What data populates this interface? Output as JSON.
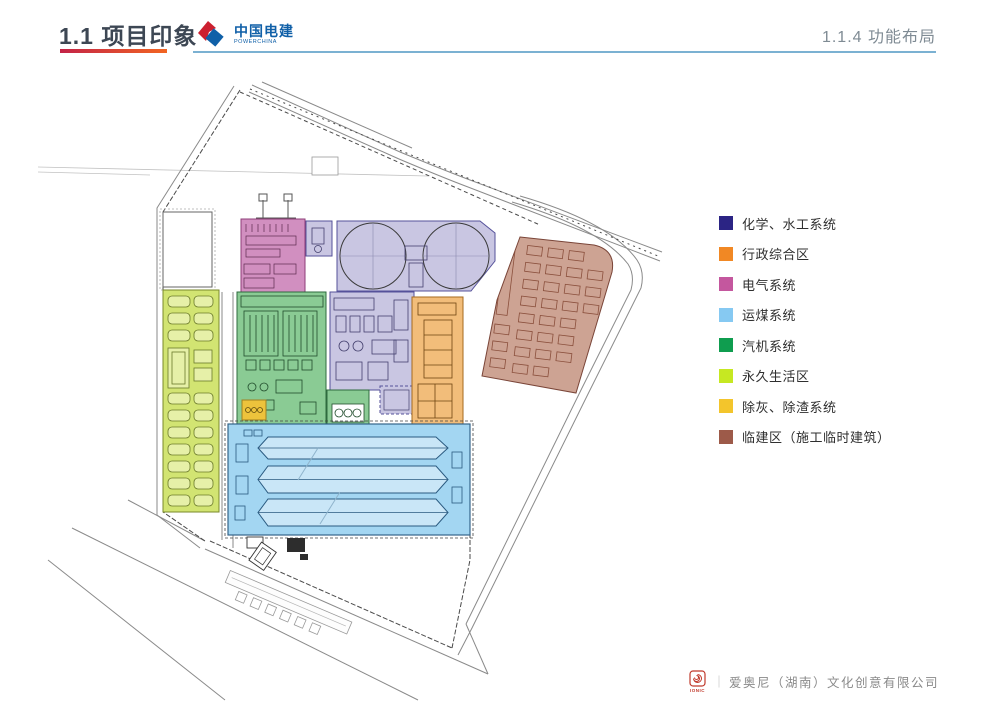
{
  "header": {
    "section_title": "1.1 项目印象",
    "subsection_title": "1.1.4 功能布局",
    "brand": {
      "name_cn": "中国电建",
      "name_en": "POWERCHINA"
    },
    "accent_colors": [
      "#c32347",
      "#f26522"
    ],
    "divider_color": "#7bb1d2"
  },
  "legend": {
    "items": [
      {
        "label": "化学、水工系统",
        "color": "#2b2484",
        "zone": "chemical"
      },
      {
        "label": "行政综合区",
        "color": "#f18824",
        "zone": "admin"
      },
      {
        "label": "电气系统",
        "color": "#c4579e",
        "zone": "electrical"
      },
      {
        "label": "运煤系统",
        "color": "#86c9f2",
        "zone": "coal"
      },
      {
        "label": "汽机系统",
        "color": "#0f9d4f",
        "zone": "turbine"
      },
      {
        "label": "永久生活区",
        "color": "#c6e822",
        "zone": "living"
      },
      {
        "label": "除灰、除渣系统",
        "color": "#f3c52c",
        "zone": "ash"
      },
      {
        "label": "临建区（施工临时建筑）",
        "color": "#9d5a49",
        "zone": "temporary"
      }
    ]
  },
  "map": {
    "zone_fills": {
      "chemical": "#c9c6e2",
      "admin": "#f2bd7a",
      "electrical": "#d18fc0",
      "coal": "#a3d6f2",
      "coal_inner": "#c9e6f7",
      "turbine": "#8acb94",
      "turbine_inner": "#e2f2e4",
      "living": "#d2e472",
      "living_inner": "#e6f0a8",
      "ash": "#edc33c",
      "temporary": "#cda393"
    }
  },
  "footer": {
    "logo_text": "IONIC",
    "separator": "｜",
    "company": "爱奥尼（湖南）文化创意有限公司"
  }
}
